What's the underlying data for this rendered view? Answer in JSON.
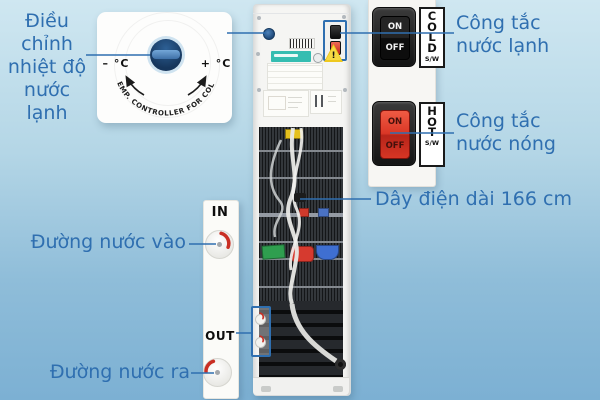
{
  "callouts": {
    "temp_adjust": {
      "line1": "Điều",
      "line2": "chỉnh",
      "line3": "nhiệt độ",
      "line4": "nước lạnh"
    },
    "cold_switch": {
      "line1": "Công tắc",
      "line2": "nước lạnh"
    },
    "hot_switch": {
      "line1": "Công tắc",
      "line2": "nước nóng"
    },
    "power_cord": "Dây điện dài 166 cm",
    "water_in": "Đường nước vào",
    "water_out": "Đường nước ra"
  },
  "dial": {
    "minus_label": "– °C",
    "plus_label": "+ °C",
    "arc_text": "TEMP. CONTROLLER FOR COLD"
  },
  "switches": {
    "cold": {
      "on": "ON",
      "off": "OFF",
      "tag": "COLD",
      "tag_sub": "S/W"
    },
    "hot": {
      "on": "ON",
      "off": "OFF",
      "tag": "HOT",
      "tag_sub": "S/W"
    }
  },
  "detail_strip": {
    "in_label": "IN",
    "out_label": "OUT"
  },
  "warning": {
    "mark": "!"
  },
  "colors": {
    "accent_blue": "#2f6fb0",
    "hot_switch_red": "#da3726",
    "cold_switch_black": "#1b1b1b",
    "knob_navy": "#16365c",
    "valve_arc_red": "#c92f24",
    "brand_label_teal": "#35bdb1",
    "warning_yellow": "#eec81e",
    "background_top": "#cfe7f1",
    "background_bottom": "#7cb0d3"
  }
}
